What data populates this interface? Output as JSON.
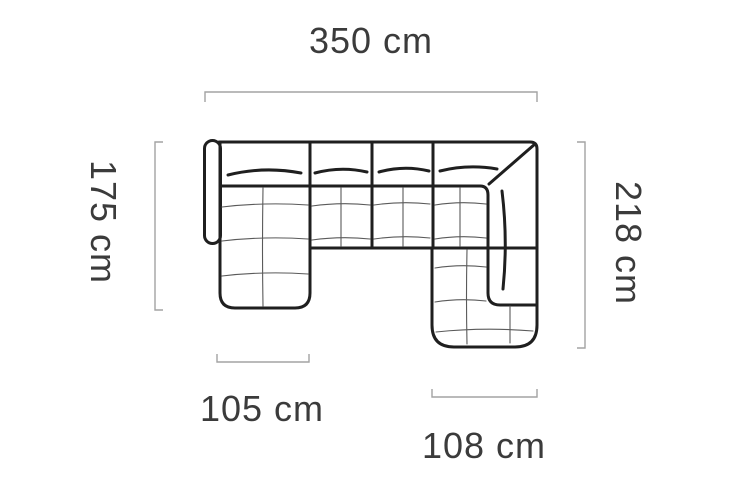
{
  "page": {
    "background": "#ffffff"
  },
  "diagram": {
    "name": "corner-sofa-top-view-dimension-diagram",
    "unit": "cm",
    "labels": {
      "width_total": "350 cm",
      "depth_left": "175 cm",
      "depth_right": "218 cm",
      "chaise_left_width": "105 cm",
      "chaise_right_width": "108 cm"
    },
    "colors": {
      "outline": "#1f1f1f",
      "seam": "#5a5a5a",
      "dim_line": "#a3a3a3",
      "label_text": "#3b3b3b",
      "background": "#ffffff"
    }
  }
}
